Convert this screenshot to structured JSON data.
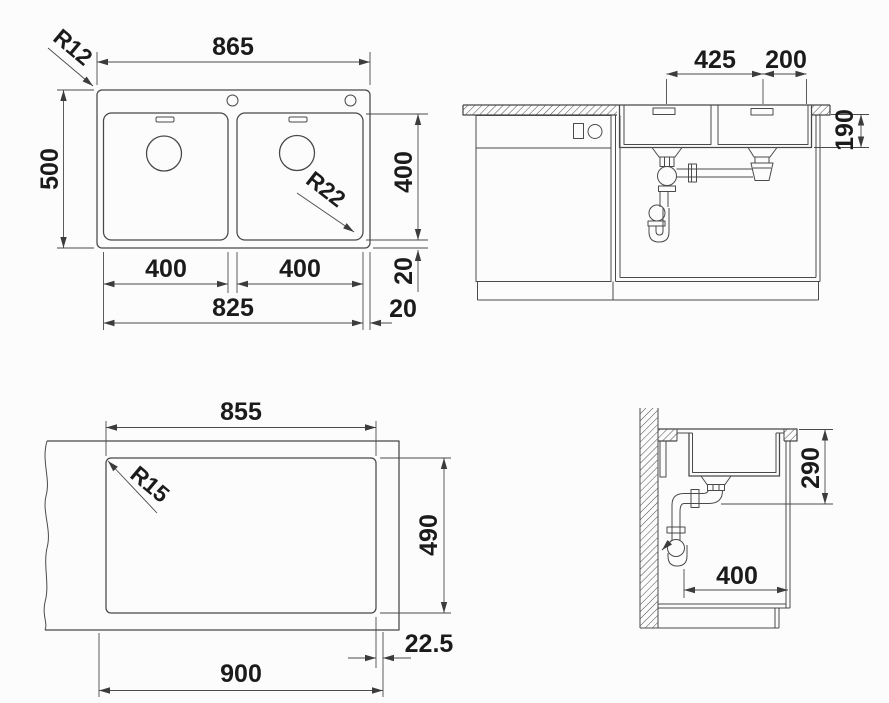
{
  "drawing": {
    "type": "technical-dimension-drawing",
    "subject": "double-bowl built-in kitchen sink with cutout and section views"
  },
  "colors": {
    "background": "#fcfcfc",
    "line": "#474747",
    "text": "#1b1b1b"
  },
  "views": {
    "top_view": {
      "dims": {
        "overall_width": "865",
        "overall_depth": "500",
        "outer_radius": "R12",
        "bowl_radius": "R22",
        "bowl_depth": "400",
        "left_bowl_width": "400",
        "right_bowl_width": "400",
        "bowls_span": "825",
        "bottom_gap": "20",
        "side_gap": "20"
      }
    },
    "front_section": {
      "dims": {
        "drain_spacing": "425",
        "drain_to_edge": "200",
        "bowl_depth": "190"
      }
    },
    "cutout_view": {
      "dims": {
        "cutout_width": "855",
        "cutout_radius": "R15",
        "cutout_depth": "490",
        "edge_offset": "22.5",
        "overall_width": "900"
      }
    },
    "side_section": {
      "dims": {
        "depth_to_drain": "290",
        "drain_offset": "400"
      }
    }
  }
}
